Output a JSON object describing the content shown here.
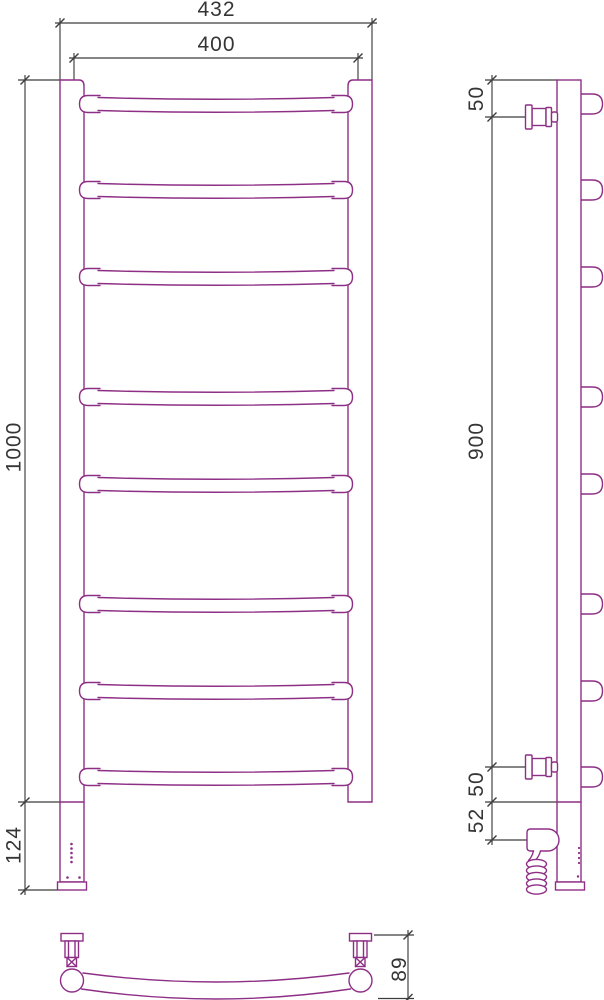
{
  "colors": {
    "part_outline": "#8E2F86",
    "dimension_lines": "#3C3C3E",
    "label_text": "#373435",
    "background": "#FFFFFF"
  },
  "views": {
    "front": {
      "label": "front view",
      "rung_count": 8,
      "dims": {
        "overall_width": "432",
        "inner_width": "400",
        "height": "1000",
        "heater_section_height": "124"
      }
    },
    "side": {
      "label": "side view",
      "dims": {
        "top_valve_offset": "50",
        "valve_span": "900",
        "bottom_valve_offset": "50",
        "heater_offset": "52"
      }
    },
    "bottom": {
      "label": "bottom view",
      "dims": {
        "wall_to_front_depth": "89"
      }
    }
  }
}
